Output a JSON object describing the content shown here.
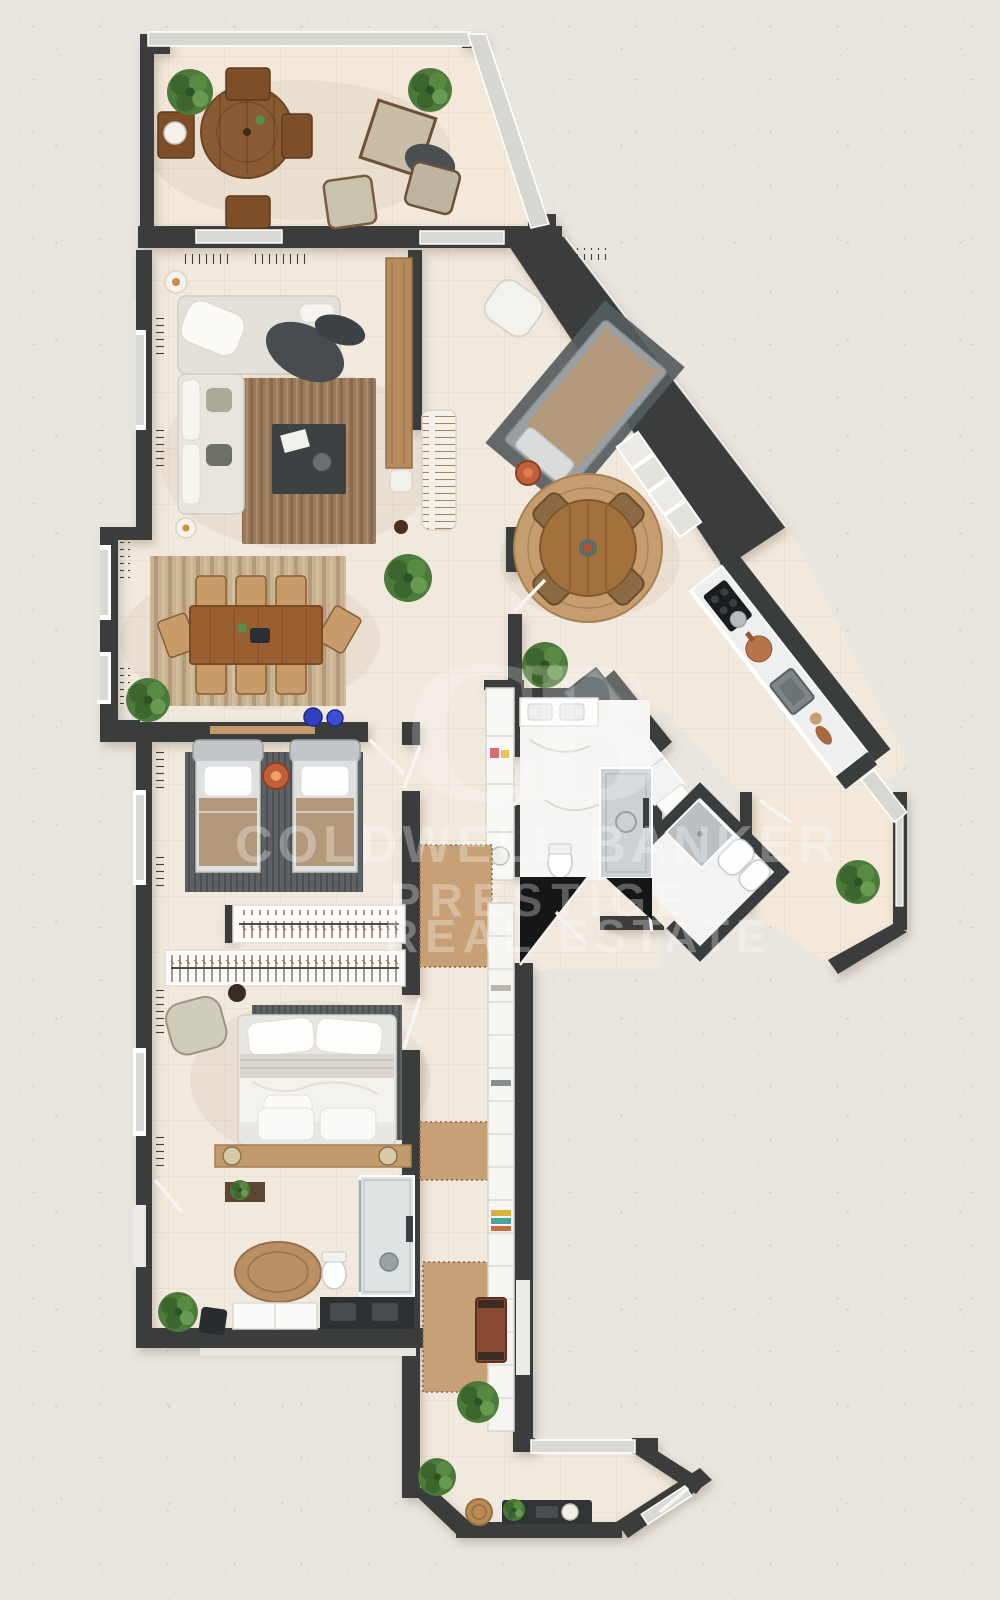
{
  "watermark": {
    "monogram": "CB",
    "lines": [
      "COLDWELL BANKER",
      "PRESTIGE",
      "REAL ESTATE"
    ],
    "color": "#ffffff",
    "opacity": 0.3
  },
  "palette": {
    "background": "#e9e5df",
    "wall": "#3a3d3e",
    "floor_tile": "#f1e9de",
    "terrace_tile": "#f3e8da",
    "window_glass": "#d9dad6",
    "window_frame": "#ffffff",
    "wood_table": "#9a5f30",
    "wood_shelf": "#c09a6a",
    "rug_brown": "#9b7a5c",
    "rug_gray": "#5d6365",
    "rug_tan": "#c7a076",
    "sofa_white": "#e8e5df",
    "marble": "#f6f5f3",
    "shower_gray": "#ccd2d4",
    "void_black": "#141618",
    "accent_orange": "#c0603a",
    "accent_blue": "#2f3fbd",
    "plant_green": "#4c7a3a"
  },
  "legend": {
    "rooms": [
      "terrace",
      "living-room",
      "dining-area",
      "open-hall",
      "kitchen",
      "kitchen-terrace",
      "bathroom",
      "laundry",
      "twin-bedroom",
      "wardrobe-closets",
      "master-bedroom",
      "ensuite-bathroom",
      "corridor",
      "entrance-hall"
    ]
  }
}
